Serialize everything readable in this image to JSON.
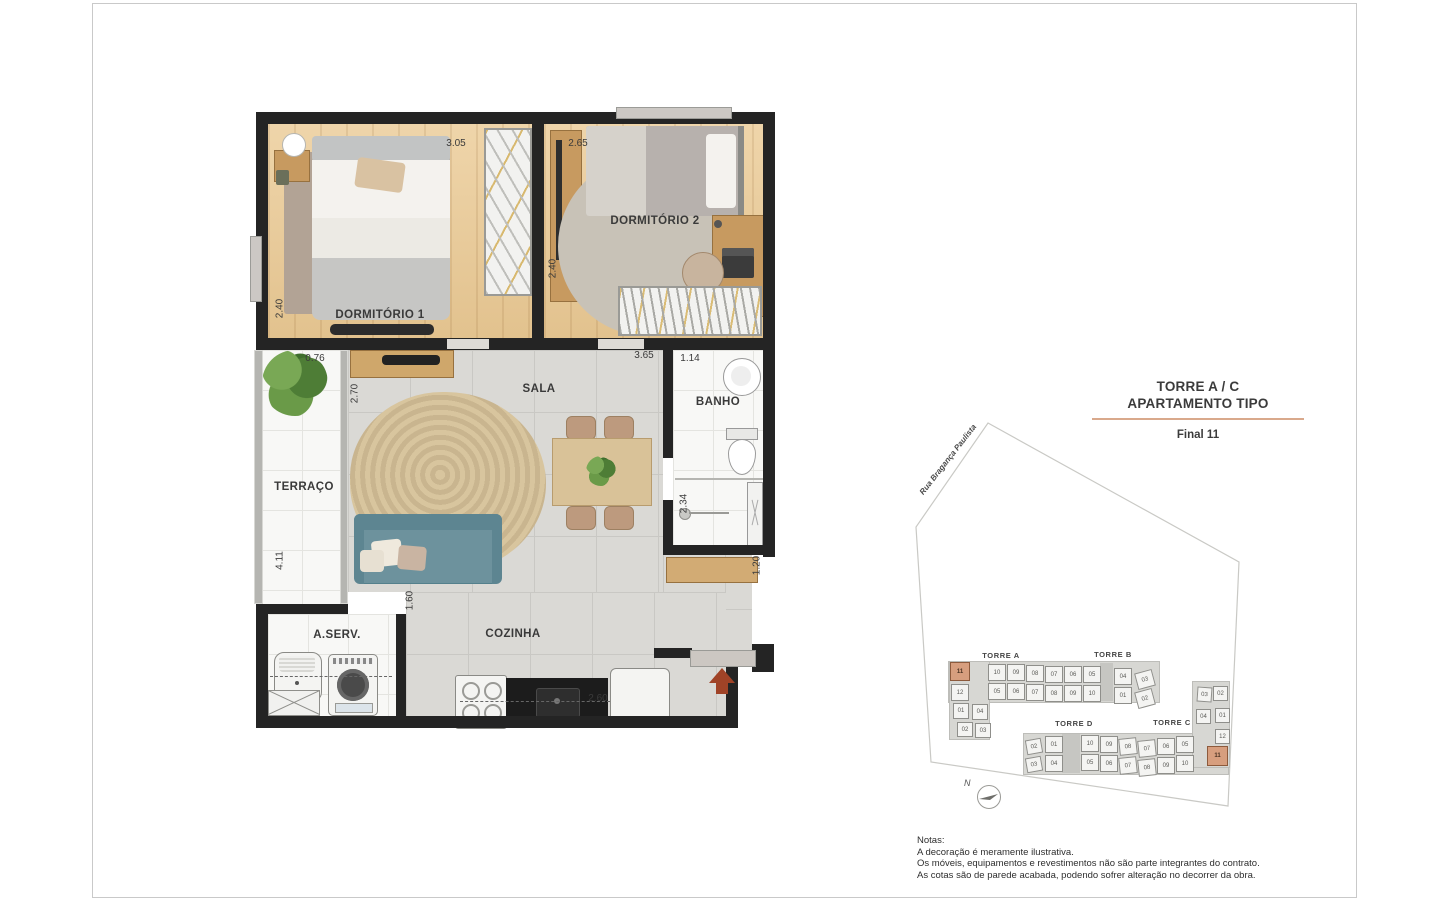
{
  "title_block": {
    "line1": "TORRE A / C",
    "line2": "APARTAMENTO TIPO",
    "final": "Final 11",
    "underline_color": "#d9a98c"
  },
  "floorplan": {
    "rooms": [
      {
        "id": "dormitorio-1",
        "label": "DORMITÓRIO 1",
        "x": 380,
        "y": 317
      },
      {
        "id": "dormitorio-2",
        "label": "DORMITÓRIO 2",
        "x": 655,
        "y": 223
      },
      {
        "id": "sala",
        "label": "SALA",
        "x": 539,
        "y": 391
      },
      {
        "id": "terraco",
        "label": "TERRAÇO",
        "x": 304,
        "y": 489
      },
      {
        "id": "banho",
        "label": "BANHO",
        "x": 718,
        "y": 404
      },
      {
        "id": "area-servico",
        "label": "A.SERV.",
        "x": 337,
        "y": 637
      },
      {
        "id": "cozinha",
        "label": "COZINHA",
        "x": 513,
        "y": 636
      }
    ],
    "dimensions": [
      {
        "value": "3.05",
        "x": 456,
        "y": 145
      },
      {
        "value": "2.65",
        "x": 578,
        "y": 145
      },
      {
        "value": "2.40",
        "x": 280,
        "y": 310,
        "rot": 1
      },
      {
        "value": "2.40",
        "x": 553,
        "y": 270,
        "rot": 1
      },
      {
        "value": "0.76",
        "x": 315,
        "y": 360
      },
      {
        "value": "2.70",
        "x": 355,
        "y": 395,
        "rot": 1
      },
      {
        "value": "3.65",
        "x": 644,
        "y": 357
      },
      {
        "value": "1.14",
        "x": 690,
        "y": 360
      },
      {
        "value": "2.34",
        "x": 684,
        "y": 505,
        "rot": 1
      },
      {
        "value": "4.11",
        "x": 280,
        "y": 562,
        "rot": 1
      },
      {
        "value": "1.60",
        "x": 410,
        "y": 602,
        "rot": 1
      },
      {
        "value": "1.20",
        "x": 757,
        "y": 567,
        "rot": 1
      },
      {
        "value": "2.60",
        "x": 598,
        "y": 700
      }
    ]
  },
  "siteplan": {
    "street_label": "Rua Bragança Paulista",
    "north_label": "N",
    "highlight_color": "#d79e7e",
    "towers": [
      {
        "label": "TORRE A",
        "x": 1001,
        "y": 656
      },
      {
        "label": "TORRE B",
        "x": 1113,
        "y": 655
      },
      {
        "label": "TORRE D",
        "x": 1074,
        "y": 724
      },
      {
        "label": "TORRE C",
        "x": 1172,
        "y": 723
      }
    ],
    "units": [
      {
        "n": "11",
        "x": 950,
        "y": 662,
        "w": 20,
        "h": 19,
        "hl": true
      },
      {
        "n": "10",
        "x": 988,
        "y": 664
      },
      {
        "n": "09",
        "x": 1007,
        "y": 664
      },
      {
        "n": "08",
        "x": 1026,
        "y": 665
      },
      {
        "n": "07",
        "x": 1045,
        "y": 666
      },
      {
        "n": "06",
        "x": 1064,
        "y": 666
      },
      {
        "n": "05",
        "x": 1083,
        "y": 666
      },
      {
        "n": "04",
        "x": 1114,
        "y": 668
      },
      {
        "n": "03",
        "x": 1136,
        "y": 671,
        "rot": -15
      },
      {
        "n": "12",
        "x": 951,
        "y": 684
      },
      {
        "n": "05",
        "x": 988,
        "y": 683
      },
      {
        "n": "06",
        "x": 1007,
        "y": 683
      },
      {
        "n": "07",
        "x": 1026,
        "y": 684
      },
      {
        "n": "08",
        "x": 1045,
        "y": 685
      },
      {
        "n": "09",
        "x": 1064,
        "y": 685
      },
      {
        "n": "10",
        "x": 1083,
        "y": 685
      },
      {
        "n": "01",
        "x": 1114,
        "y": 687
      },
      {
        "n": "02",
        "x": 1136,
        "y": 690,
        "rot": -15
      },
      {
        "n": "01",
        "x": 953,
        "y": 703,
        "w": 16,
        "h": 16
      },
      {
        "n": "04",
        "x": 972,
        "y": 704,
        "w": 16,
        "h": 16
      },
      {
        "n": "02",
        "x": 957,
        "y": 722,
        "w": 16,
        "h": 15
      },
      {
        "n": "03",
        "x": 975,
        "y": 723,
        "w": 16,
        "h": 15
      },
      {
        "n": "02",
        "x": 1026,
        "y": 739,
        "w": 16,
        "h": 15,
        "rot": -10
      },
      {
        "n": "01",
        "x": 1045,
        "y": 736
      },
      {
        "n": "10",
        "x": 1081,
        "y": 735
      },
      {
        "n": "09",
        "x": 1100,
        "y": 736
      },
      {
        "n": "08",
        "x": 1119,
        "y": 738,
        "rot": -6
      },
      {
        "n": "07",
        "x": 1138,
        "y": 740,
        "rot": -6
      },
      {
        "n": "06",
        "x": 1157,
        "y": 738
      },
      {
        "n": "05",
        "x": 1176,
        "y": 736
      },
      {
        "n": "03",
        "x": 1026,
        "y": 757,
        "w": 16,
        "h": 15,
        "rot": -10
      },
      {
        "n": "04",
        "x": 1045,
        "y": 755
      },
      {
        "n": "05",
        "x": 1081,
        "y": 754
      },
      {
        "n": "06",
        "x": 1100,
        "y": 755
      },
      {
        "n": "07",
        "x": 1119,
        "y": 757,
        "rot": -6
      },
      {
        "n": "08",
        "x": 1138,
        "y": 759,
        "rot": -6
      },
      {
        "n": "09",
        "x": 1157,
        "y": 757
      },
      {
        "n": "10",
        "x": 1176,
        "y": 755
      },
      {
        "n": "03",
        "x": 1197,
        "y": 687,
        "w": 15,
        "h": 15,
        "rot": 4
      },
      {
        "n": "02",
        "x": 1213,
        "y": 686,
        "w": 15,
        "h": 15
      },
      {
        "n": "04",
        "x": 1196,
        "y": 709,
        "w": 15,
        "h": 15
      },
      {
        "n": "01",
        "x": 1215,
        "y": 708,
        "w": 15,
        "h": 15
      },
      {
        "n": "12",
        "x": 1215,
        "y": 729,
        "w": 15,
        "h": 15
      },
      {
        "n": "11",
        "x": 1207,
        "y": 746,
        "w": 21,
        "h": 20,
        "hl": true
      }
    ]
  },
  "notes": {
    "heading": "Notas:",
    "lines": [
      "A decoração é meramente ilustrativa.",
      "Os móveis, equipamentos e revestimentos não são parte integrantes do contrato.",
      "As cotas são de parede acabada, podendo sofrer alteração no decorrer da obra."
    ]
  }
}
